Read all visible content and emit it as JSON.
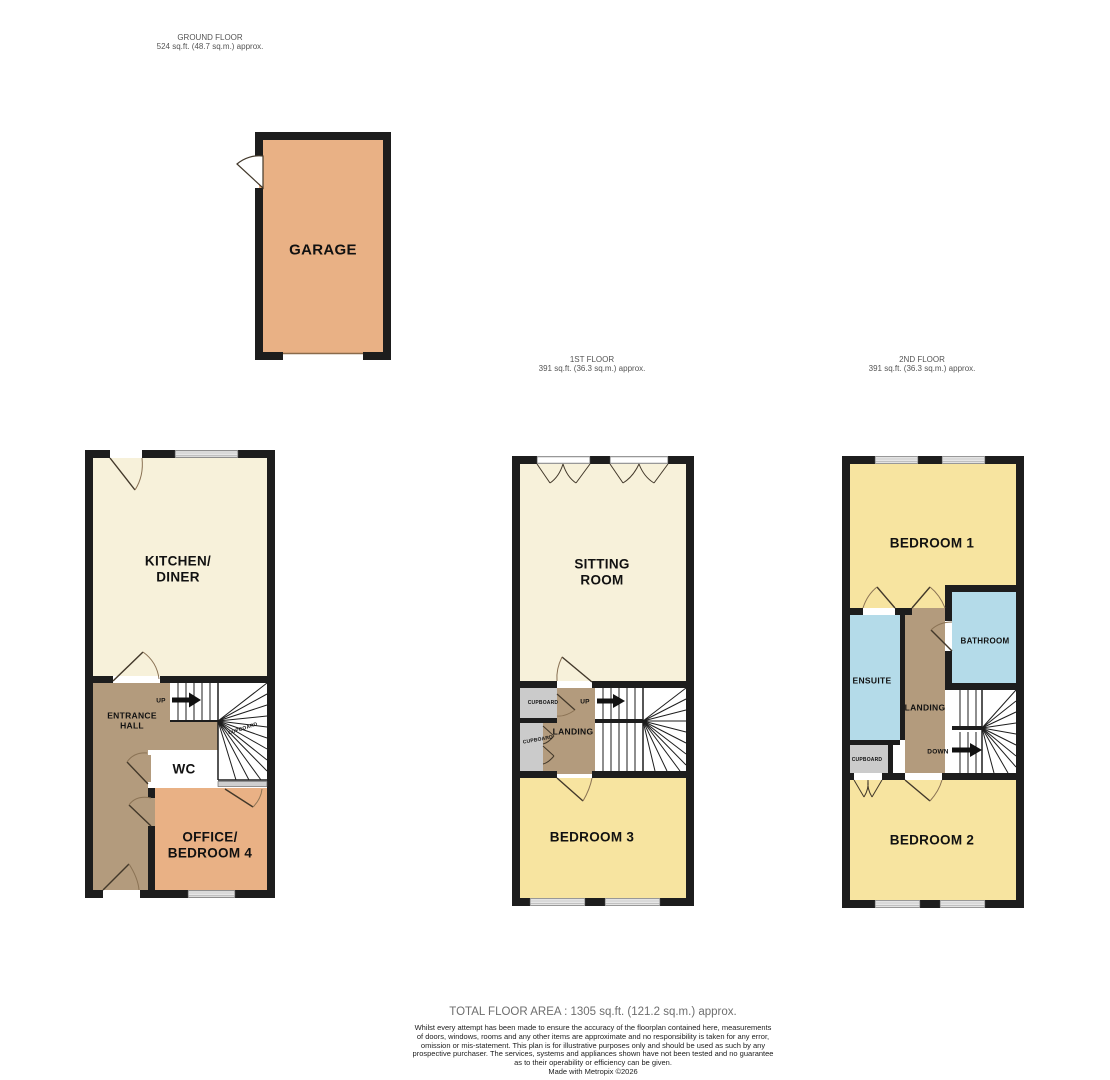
{
  "colors": {
    "wall": "#1d1d1d",
    "room_cream": "#f7f1da",
    "room_orange": "#e9b185",
    "room_yellow": "#f7e4a0",
    "room_blue": "#b4dbe9",
    "room_brown": "#b39b7d",
    "room_gray": "#cbcbcb",
    "door_leaf": "#42382a",
    "door_arc": "#8a7254",
    "window_line": "#9a9a9a"
  },
  "floors": {
    "ground": {
      "title": "GROUND FLOOR",
      "area": "524 sq.ft. (48.7 sq.m.) approx.",
      "rooms": {
        "garage": "GARAGE",
        "kitchen_diner": "KITCHEN/\nDINER",
        "entrance_hall": "ENTRANCE\nHALL",
        "up": "UP",
        "cupboard": "CUPBOARD",
        "wc": "WC",
        "office_bedroom4": "OFFICE/\nBEDROOM 4"
      }
    },
    "first": {
      "title": "1ST FLOOR",
      "area": "391 sq.ft. (36.3 sq.m.) approx.",
      "rooms": {
        "sitting_room": "SITTING\nROOM",
        "cupboard_top": "CUPBOARD",
        "cupboard_bottom": "CUPBOARD",
        "landing": "LANDING",
        "up": "UP",
        "bedroom3": "BEDROOM 3"
      }
    },
    "second": {
      "title": "2ND FLOOR",
      "area": "391 sq.ft. (36.3 sq.m.) approx.",
      "rooms": {
        "bedroom1": "BEDROOM 1",
        "ensuite": "ENSUITE",
        "landing": "LANDING",
        "bathroom": "BATHROOM",
        "cupboard": "CUPBOARD",
        "down": "DOWN",
        "bedroom2": "BEDROOM 2"
      }
    }
  },
  "footer": {
    "total_area": "TOTAL FLOOR AREA : 1305 sq.ft. (121.2 sq.m.) approx.",
    "disclaimer_lines": [
      "Whilst every attempt has been made to ensure the accuracy of the floorplan contained here, measurements",
      "of doors, windows, rooms and any other items are approximate and no responsibility is taken for any error,",
      "omission or mis-statement. This plan is for illustrative purposes only and should be used as such by any",
      "prospective purchaser. The services, systems and appliances shown have not been tested and no guarantee",
      "as to their operability or efficiency can be given."
    ],
    "credit": "Made with Metropix ©2026"
  }
}
